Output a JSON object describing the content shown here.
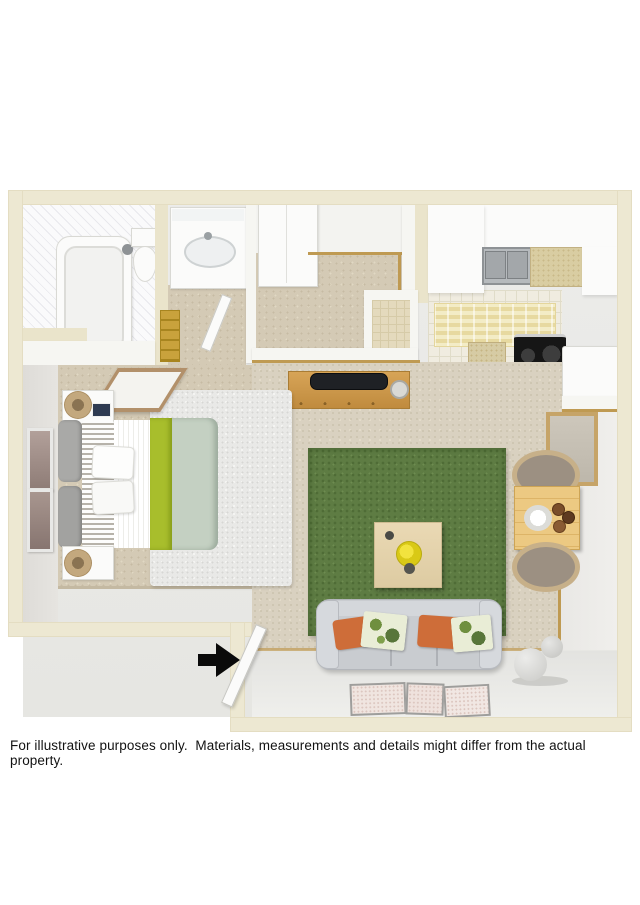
{
  "disclaimer": {
    "text": "For illustrative purposes only.  Materials, measurements and details might differ from the actual property."
  },
  "colors": {
    "page_background": "#ffffff",
    "outer_wall": "#ede8d2",
    "bedroom_carpet": "#d4cab5",
    "living_floor": "#d9d1c0",
    "bath_tile": "#f3f3f5",
    "kitchen_tile": "#f0ece0",
    "area_rug_green": "#5e7c43",
    "bed_accent_green": "#a8be2c",
    "bed_blanket_sage": "#c4d0c2",
    "sofa_gray": "#c9ccd0",
    "pillow_orange": "#ce6d39",
    "wood_console": "#ce9a4e",
    "dining_table_wood": "#ebc87e",
    "threshold_trim_gold": "#bf9a52",
    "appliance_black": "#1a1a1a",
    "entry_arrow": "#0a0a0a"
  }
}
